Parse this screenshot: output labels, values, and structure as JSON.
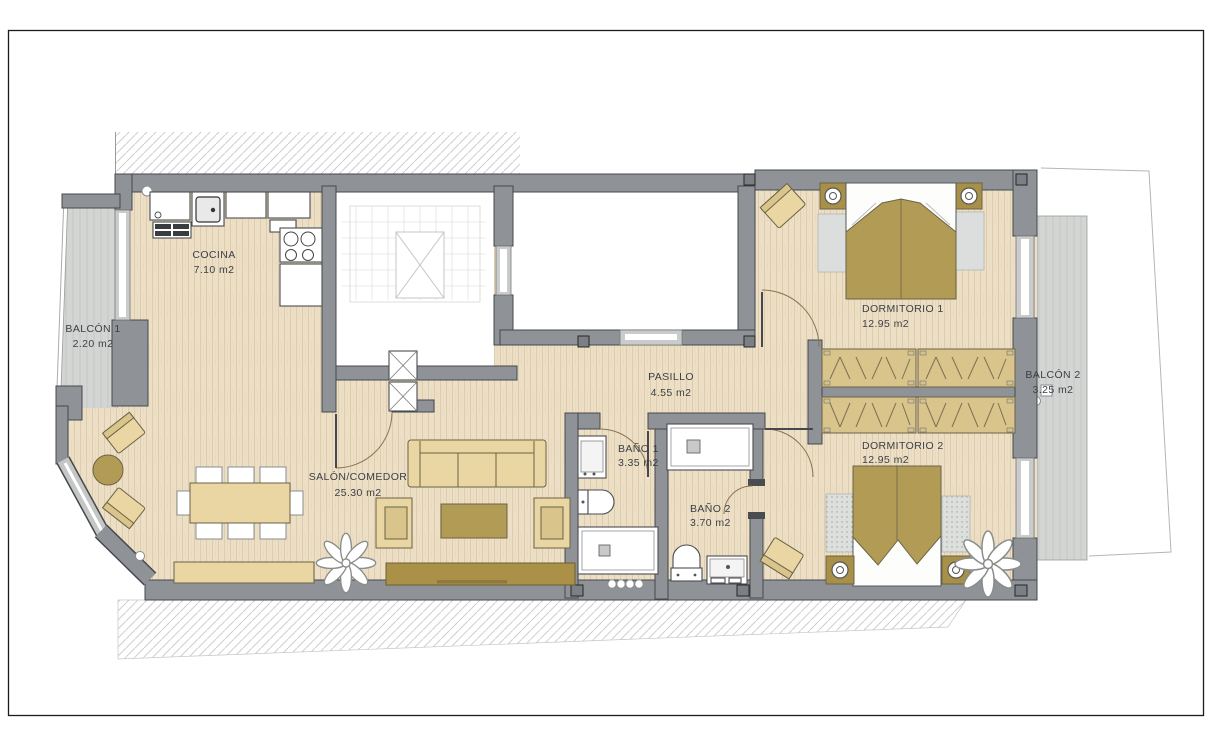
{
  "plan": {
    "title": "Apartment floor plan",
    "rooms": [
      {
        "id": "cocina",
        "name": "COCINA",
        "area": "7.10 m2"
      },
      {
        "id": "balcon1",
        "name": "BALCÓN 1",
        "area": "2.20 m2"
      },
      {
        "id": "salon",
        "name": "SALÓN/COMEDOR",
        "area": "25.30 m2"
      },
      {
        "id": "pasillo",
        "name": "PASILLO",
        "area": "4.55 m2"
      },
      {
        "id": "bano1",
        "name": "BAÑO 1",
        "area": "3.35 m2"
      },
      {
        "id": "bano2",
        "name": "BAÑO 2",
        "area": "3.70 m2"
      },
      {
        "id": "dormitorio1",
        "name": "DORMITORIO 1",
        "area": "12.95 m2"
      },
      {
        "id": "dormitorio2",
        "name": "DORMITORIO 2",
        "area": "12.95 m2"
      },
      {
        "id": "balcon2",
        "name": "BALCÓN 2",
        "area": "3.25 m2"
      }
    ],
    "colors": {
      "wall": "#8f9296",
      "floor": "#ecdfc6",
      "balcony_floor": "#d3d5d3",
      "furniture_tan": "#e9d6a3",
      "accent_dark_tan": "#b29c55",
      "label_text": "#3c4046",
      "hatch_line": "#cfcfcf"
    },
    "furniture": {
      "cocina": [
        "fridge",
        "kitchen-sink",
        "counter",
        "stove",
        "cabinet",
        "drawers"
      ],
      "salon": [
        "armchair",
        "armchair",
        "round-side-table",
        "dining-table",
        "dining-chairs-x8",
        "sideboard",
        "sofa",
        "coffee-table",
        "armchair",
        "armchair",
        "tv-cabinet",
        "plant"
      ],
      "dormitorio1": [
        "double-bed",
        "nightstand",
        "nightstand",
        "lamp",
        "lamp",
        "rug",
        "rug",
        "armchair",
        "wardrobes"
      ],
      "dormitorio2": [
        "double-bed",
        "nightstand",
        "nightstand",
        "lamp",
        "lamp",
        "rug",
        "rug",
        "armchair",
        "wardrobes",
        "plant"
      ],
      "bano1": [
        "sink",
        "toilet",
        "bathtub"
      ],
      "bano2": [
        "shower",
        "toilet",
        "sink"
      ]
    }
  }
}
